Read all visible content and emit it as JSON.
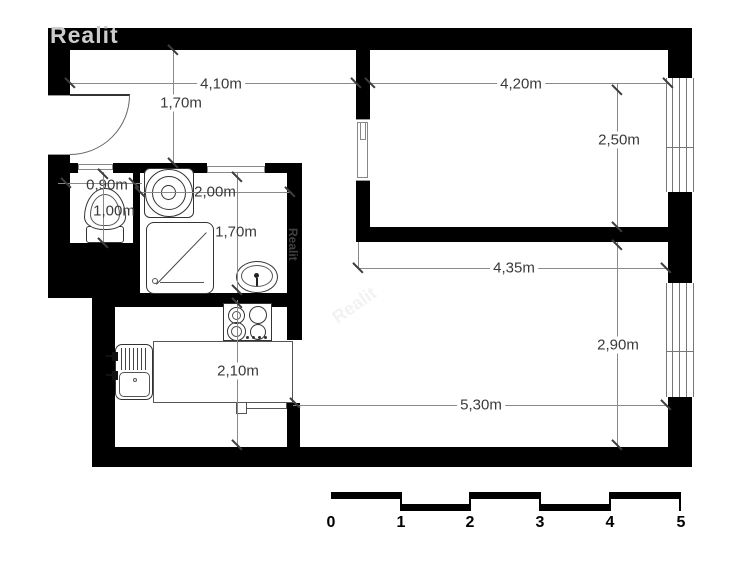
{
  "watermark": {
    "text": "Realit"
  },
  "dimensions": [
    {
      "name": "hall-width",
      "label": "4,10m"
    },
    {
      "name": "hall-depth",
      "label": "1,70m"
    },
    {
      "name": "bedroom-width",
      "label": "4,20m"
    },
    {
      "name": "bedroom-depth",
      "label": "2,50m"
    },
    {
      "name": "wc-width",
      "label": "0,90m"
    },
    {
      "name": "wc-depth",
      "label": "1,00m"
    },
    {
      "name": "bathroom-width",
      "label": "2,00m"
    },
    {
      "name": "bathroom-depth",
      "label": "1,70m"
    },
    {
      "name": "living-width-top",
      "label": "4,35m"
    },
    {
      "name": "living-depth",
      "label": "2,90m"
    },
    {
      "name": "kitchen-depth",
      "label": "2,10m"
    },
    {
      "name": "living-width-bottom",
      "label": "5,30m"
    }
  ],
  "scale_bar": {
    "unit": "m",
    "labels": [
      "0",
      "1",
      "2",
      "3",
      "4",
      "5"
    ]
  },
  "fixtures": [
    "entrance-door",
    "toilet",
    "washing-machine",
    "shower-tray",
    "washbasin",
    "stove",
    "kitchen-sink",
    "kitchen-counter",
    "sliding-door",
    "pocket-door",
    "window",
    "window"
  ],
  "colors": {
    "wall": "#000000",
    "dimension_line": "#8a8a8a",
    "dimension_text": "#3a3a3a",
    "fixture_outline": "#333333",
    "watermark": "#cccccc",
    "background": "#ffffff"
  }
}
